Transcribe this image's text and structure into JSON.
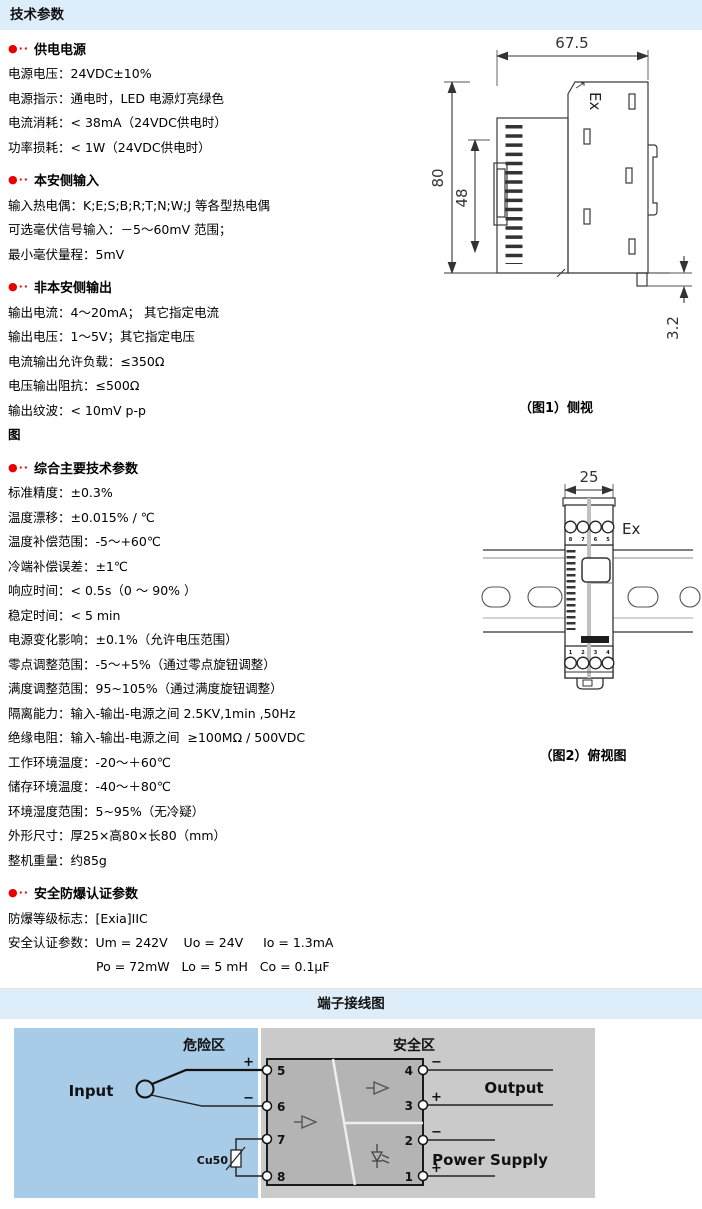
{
  "header": {
    "title": "技术参数"
  },
  "icons": {
    "section_bullet": "●··"
  },
  "specs": {
    "sections": [
      {
        "title": "供电电源",
        "items": [
          "电源电压：24VDC±10%",
          "电源指示：通电时，LED 电源灯亮绿色",
          "电流消耗：< 38mA（24VDC供电时）",
          "功率损耗：< 1W（24VDC供电时）"
        ]
      },
      {
        "title": "本安侧输入",
        "items": [
          "输入热电偶：K;E;S;B;R;T;N;W;J 等各型热电偶",
          "可选毫伏信号输入：－5～60mV 范围；",
          "最小毫伏量程：5mV"
        ]
      },
      {
        "title": "非本安侧输出",
        "items": [
          "输出电流：4～20mA； 其它指定电流",
          "输出电压：1～5V；其它指定电压",
          "电流输出允许负载：≤350Ω",
          "电压输出阻抗：≤500Ω",
          "输出纹波：< 10mV p-p",
          "图"
        ]
      },
      {
        "title": "综合主要技术参数",
        "items": [
          "标准精度：±0.3%",
          "温度漂移：±0.015% / ℃",
          "温度补偿范围：-5～+60℃",
          "冷端补偿误差：±1℃",
          "响应时间：< 0.5s（0 ～ 90% ）",
          "稳定时间：< 5 min",
          "电源变化影响：±0.1%（允许电压范围）",
          "零点调整范围：-5～+5%（通过零点旋钮调整）",
          "满度调整范围：95~105%（通过满度旋钮调整）",
          "隔离能力：输入-输出-电源之间 2.5KV,1min ,50Hz",
          "绝缘电阻：输入-输出-电源之间  ≥100MΩ / 500VDC",
          "工作环境温度：-20～＋60℃",
          "储存环境温度：-40～＋80℃",
          "环境湿度范围：5~95%（无冷疑）",
          "外形尺寸：厚25×高80×长80（mm）",
          "整机重量：约85g"
        ]
      },
      {
        "title": "安全防爆认证参数",
        "items": [
          "防爆等级标志：[Exia]IIC",
          "安全认证参数：Um = 242V    Uo = 24V     Io = 1.3mA",
          "Po = 72mW   Lo = 5 mH   Co = 0.1μF"
        ]
      }
    ]
  },
  "fig1": {
    "dim_width": "67.5",
    "dim_height": "80",
    "dim_inner": "48",
    "dim_foot": "3.2",
    "ex_label": "Ex",
    "caption": "（图1）侧视"
  },
  "fig2": {
    "dim_width": "25",
    "ex_label": "Ex",
    "top_terminals": [
      "8",
      "7",
      "6",
      "5"
    ],
    "bottom_terminals": [
      "1",
      "2",
      "3",
      "4"
    ],
    "caption": "（图2）俯视图"
  },
  "wiring": {
    "header": "端子接线图",
    "zones": {
      "hazard": "危险区",
      "safe": "安全区"
    },
    "labels": {
      "input": "Input",
      "output": "Output",
      "power": "Power Supply",
      "sensor": "Cu50"
    },
    "left_terminals": [
      {
        "n": "5",
        "sign": "+"
      },
      {
        "n": "6",
        "sign": "−"
      },
      {
        "n": "7",
        "sign": ""
      },
      {
        "n": "8",
        "sign": ""
      }
    ],
    "right_terminals": [
      {
        "n": "4",
        "sign": "−"
      },
      {
        "n": "3",
        "sign": "+"
      },
      {
        "n": "2",
        "sign": "−"
      },
      {
        "n": "1",
        "sign": "+"
      }
    ],
    "colors": {
      "hazard_bg": "#a8cbe8",
      "safe_bg": "#cacaca",
      "box_bg": "#b4b4b4"
    }
  }
}
